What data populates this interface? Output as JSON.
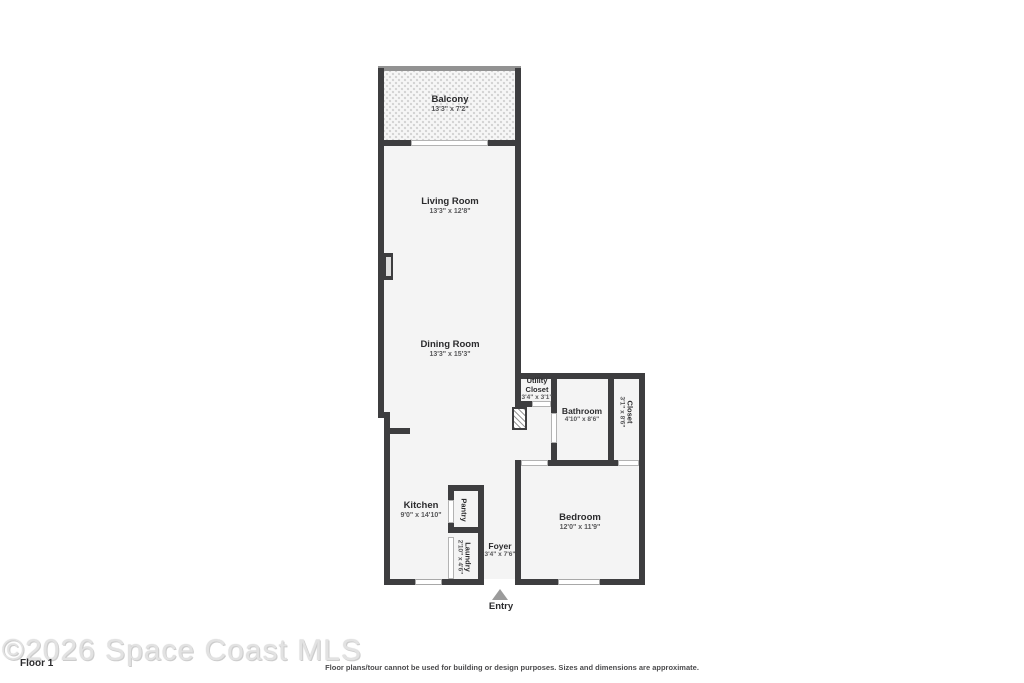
{
  "rooms": {
    "balcony": {
      "name": "Balcony",
      "dims": "13'3\" x 7'2\""
    },
    "living_room": {
      "name": "Living Room",
      "dims": "13'3\" x 12'8\""
    },
    "dining_room": {
      "name": "Dining Room",
      "dims": "13'3\" x 15'3\""
    },
    "utility_closet": {
      "name": "Utility Closet",
      "dims": "3'4\" x 3'1\""
    },
    "bathroom": {
      "name": "Bathroom",
      "dims": "4'10\" x 8'6\""
    },
    "closet": {
      "name": "Closet",
      "dims": "3'1\" x 8'6\""
    },
    "kitchen": {
      "name": "Kitchen",
      "dims": "9'0\" x 14'10\""
    },
    "pantry": {
      "name": "Pantry",
      "dims": ""
    },
    "laundry": {
      "name": "Laundry",
      "dims": "2'10\" x 4'6\""
    },
    "foyer": {
      "name": "Foyer",
      "dims": "3'4\" x 7'6\""
    },
    "bedroom": {
      "name": "Bedroom",
      "dims": "12'0\" x 11'9\""
    }
  },
  "entry": {
    "label": "Entry"
  },
  "footer": {
    "watermark": "©2026 Space Coast MLS",
    "floor_label": "Floor 1",
    "disclaimer": "Floor plans/tour cannot be used for building or design purposes. Sizes and dimensions are approximate."
  },
  "colors": {
    "wall": "#3d3d3f",
    "room_fill": "#f4f4f4",
    "door_line": "#b3b3b3",
    "entry_arrow": "#9b9b9b",
    "watermark_gray": "#e2e2e2"
  }
}
